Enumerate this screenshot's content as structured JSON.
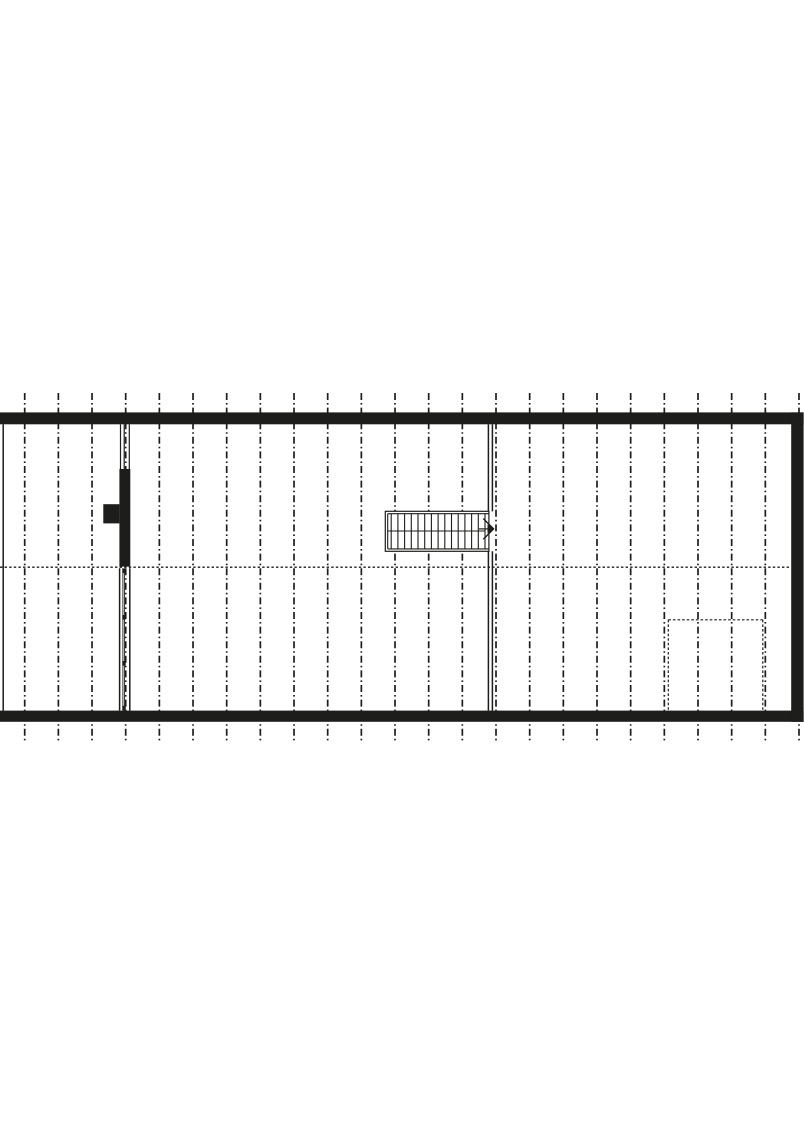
{
  "page": {
    "background_color": "#ffffff",
    "ink_color": "#1d1d1b"
  },
  "plan": {
    "kind": "architectural-floor-plan",
    "canvas": {
      "width": 804,
      "height": 1136
    },
    "grid": {
      "style": "dash-dot",
      "count": 24,
      "x_start": 24.7,
      "spacing": 33.665,
      "y_top": 393,
      "y_bottom": 740.5,
      "stroke_width": 1.7,
      "dash_pattern": "7 3 1.6 3"
    },
    "exterior_walls": {
      "top": {
        "x": 0,
        "y": 412.4,
        "w": 803.6,
        "h": 11.9
      },
      "bottom": {
        "x": 0,
        "y": 710.6,
        "w": 803.6,
        "h": 11.2
      },
      "right": {
        "x": 791.2,
        "y": 412.4,
        "w": 12.4,
        "h": 309.4
      },
      "left_line": {
        "x": 3.2,
        "y1": 424.3,
        "y2": 710.6,
        "stroke_width": 1.5
      }
    },
    "interior_wall": {
      "x_lines": [
        488.4,
        492.4
      ],
      "stroke_width": 1.5,
      "segments": [
        {
          "y1": 424.3,
          "y2": 511.4
        },
        {
          "y1": 551.2,
          "y2": 710.6
        }
      ]
    },
    "stair": {
      "outer": {
        "x": 385.3,
        "y": 511.3,
        "w": 103.6,
        "h": 40.0
      },
      "inner_offset": 2.4,
      "right_open_x": 488.9,
      "tread_count": 15,
      "tread_x_from": 391.2,
      "tread_x_to": 485.0,
      "tread_y1": 513.7,
      "tread_y2": 548.6,
      "center_line_y": 531.0,
      "stroke_width": 1.1,
      "arrow": {
        "tail": {
          "x1": 479.0,
          "x2": 488.5,
          "y": 528.9
        },
        "chevron_points": "483.3,518.6 493.6,528.9 483.3,539.2",
        "tip_points": "487.5,524.3 494.2,528.9 487.5,533.5"
      }
    },
    "chimney_assembly": {
      "upper_thin_lines": {
        "x_list": [
          120.5,
          124.2,
          129.3
        ],
        "y1": 424.3,
        "y2": 469.0,
        "stroke_width": 1.2
      },
      "black_mass": {
        "x": 119.4,
        "y": 469.0,
        "w": 10.9,
        "h": 97.6
      },
      "left_tab": {
        "x": 103.3,
        "y": 504.2,
        "w": 16.1,
        "h": 19.2
      },
      "lower_wall": {
        "y1": 568.2,
        "y2": 710.6,
        "outer_x": [
          119.6,
          129.8
        ],
        "outer_stroke": 1.5,
        "inner_x": [
          122.9,
          124.6
        ],
        "inner_stroke": 0.9,
        "tick": {
          "x": 122.3,
          "w": 3.4,
          "h": 4.6,
          "y_list": [
            568.5,
            615.0,
            661.0,
            705.8
          ]
        }
      }
    },
    "dotted_level_line": {
      "y": 567.2,
      "x1": 0,
      "x2": 791,
      "stroke_width": 1.3,
      "dash_pattern": "2.4 2.2"
    },
    "dashed_recess": {
      "x1": 668.3,
      "x2": 762.8,
      "y_top": 619.8,
      "y_bottom": 710.6,
      "stroke_width": 1.2,
      "dash_pattern": "2.6 2"
    }
  }
}
